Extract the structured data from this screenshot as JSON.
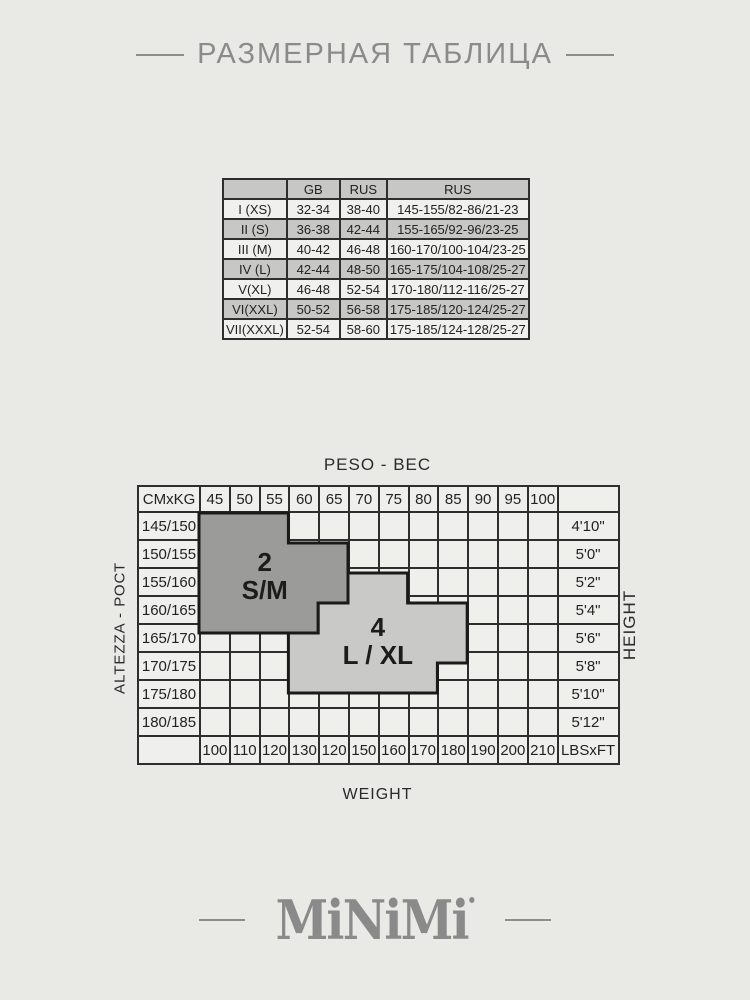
{
  "title": {
    "text": "РАЗМЕРНАЯ ТАБЛИЦА"
  },
  "size_table": {
    "headers": [
      "",
      "GB",
      "RUS",
      "RUS"
    ],
    "rows": [
      [
        "I (XS)",
        "32-34",
        "38-40",
        "145-155/82-86/21-23"
      ],
      [
        "II (S)",
        "36-38",
        "42-44",
        "155-165/92-96/23-25"
      ],
      [
        "III (M)",
        "40-42",
        "46-48",
        "160-170/100-104/23-25"
      ],
      [
        "IV (L)",
        "42-44",
        "48-50",
        "165-175/104-108/25-27"
      ],
      [
        "V(XL)",
        "46-48",
        "52-54",
        "170-180/112-116/25-27"
      ],
      [
        "VI(XXL)",
        "50-52",
        "56-58",
        "175-185/120-124/25-27"
      ],
      [
        "VII(XXXL)",
        "52-54",
        "58-60",
        "175-185/124-128/25-27"
      ]
    ]
  },
  "grid": {
    "top_label": "PESO - ВЕС",
    "bottom_label": "WEIGHT",
    "left_label": "ALTEZZA - РОСТ",
    "right_label": "HEIGHT",
    "corner_label": "CMxKG",
    "lbs_unit": "LBSxFT",
    "weights_kg": [
      "45",
      "50",
      "55",
      "60",
      "65",
      "70",
      "75",
      "80",
      "85",
      "90",
      "95",
      "100"
    ],
    "heights_cm": [
      "145/150",
      "150/155",
      "155/160",
      "160/165",
      "165/170",
      "170/175",
      "175/180",
      "180/185"
    ],
    "heights_ft": [
      "4'10\"",
      "5'0\"",
      "5'2\"",
      "5'4\"",
      "5'6\"",
      "5'8\"",
      "5'10\"",
      "5'12\""
    ],
    "weights_lbs": [
      "100",
      "110",
      "120",
      "130",
      "120",
      "150",
      "160",
      "170",
      "180",
      "190",
      "200",
      "210"
    ],
    "regions": [
      {
        "number": "2",
        "size": "S/M",
        "fill": "#9b9b9a",
        "cells": [
          [
            0,
            0,
            2
          ],
          [
            1,
            0,
            4
          ],
          [
            2,
            0,
            4
          ],
          [
            3,
            0,
            3
          ]
        ]
      },
      {
        "number": "4",
        "size": "L / XL",
        "fill": "#c9c9c7",
        "cells": [
          [
            2,
            5,
            6
          ],
          [
            3,
            4,
            8
          ],
          [
            4,
            3,
            8
          ],
          [
            5,
            3,
            7
          ]
        ]
      }
    ],
    "colors": {
      "border": "#1a1a1a",
      "cell": "#efefec"
    }
  },
  "logo": {
    "text": "MiNiMi",
    "mark_icon": "registered-dot"
  }
}
